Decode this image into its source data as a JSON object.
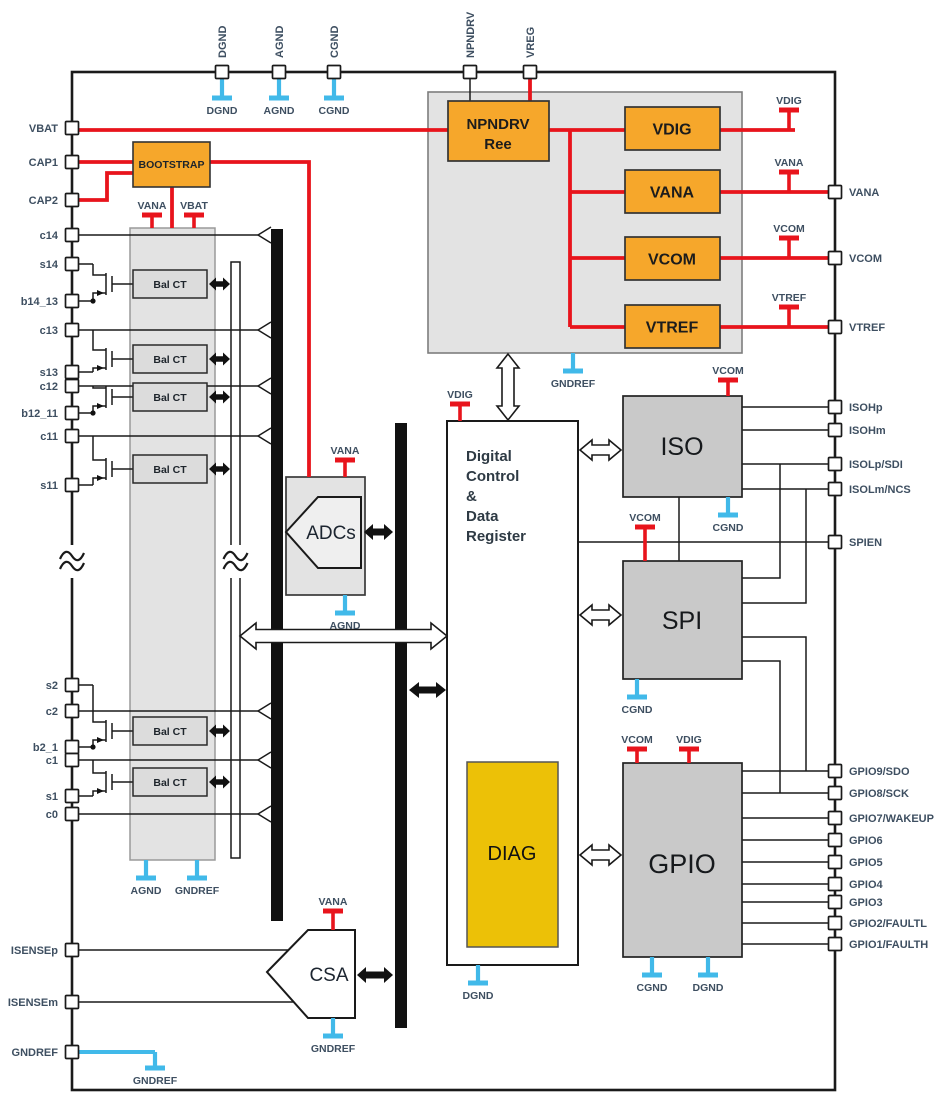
{
  "pins": {
    "top": [
      "DGND",
      "AGND",
      "CGND",
      "NPNDRV",
      "VREG"
    ],
    "left": [
      "VBAT",
      "CAP1",
      "CAP2",
      "c14",
      "s14",
      "b14_13",
      "c13",
      "s13",
      "c12",
      "b12_11",
      "c11",
      "s11",
      "s2",
      "c2",
      "b2_1",
      "c1",
      "s1",
      "c0",
      "ISENSEp",
      "ISENSEm",
      "GNDREF"
    ],
    "right": [
      "VANA",
      "VCOM",
      "VTREF",
      "ISOHp",
      "ISOHm",
      "ISOLp/SDI",
      "ISOLm/NCS",
      "SPIEN",
      "GPIO9/SDO",
      "GPIO8/SCK",
      "GPIO7/WAKEUP",
      "GPIO6",
      "GPIO5",
      "GPIO4",
      "GPIO3",
      "GPIO2/FAULTL",
      "GPIO1/FAULTH"
    ]
  },
  "blocks": {
    "bootstrap": "BOOTSTRAP",
    "npndrv_line1": "NPNDRV",
    "npndrv_line2": "Ree",
    "reg_vdig": "VDIG",
    "reg_vana": "VANA",
    "reg_vcom": "VCOM",
    "reg_vtref": "VTREF",
    "bal_ct": "Bal CT",
    "adcs": "ADCs",
    "digital_line1": "Digital",
    "digital_line2": "Control",
    "digital_line3": "&",
    "digital_line4": "Data",
    "digital_line5": "Register",
    "diag": "DIAG",
    "iso": "ISO",
    "spi": "SPI",
    "gpio": "GPIO",
    "csa": "CSA"
  },
  "net_labels": {
    "vdig": "VDIG",
    "vana": "VANA",
    "vcom": "VCOM",
    "vtref": "VTREF",
    "vbat": "VBAT",
    "dgnd": "DGND",
    "agnd": "AGND",
    "cgnd": "CGND",
    "gndref": "GNDREF"
  },
  "colors": {
    "wire_red": "#e8141c",
    "ground_cyan": "#41b9e9",
    "block_orange": "#f6a72b",
    "diag_yellow": "#ecc107",
    "block_gray": "#c9c9c9",
    "panel_gray": "#e3e3e3",
    "label_blue": "#3e4f61"
  }
}
